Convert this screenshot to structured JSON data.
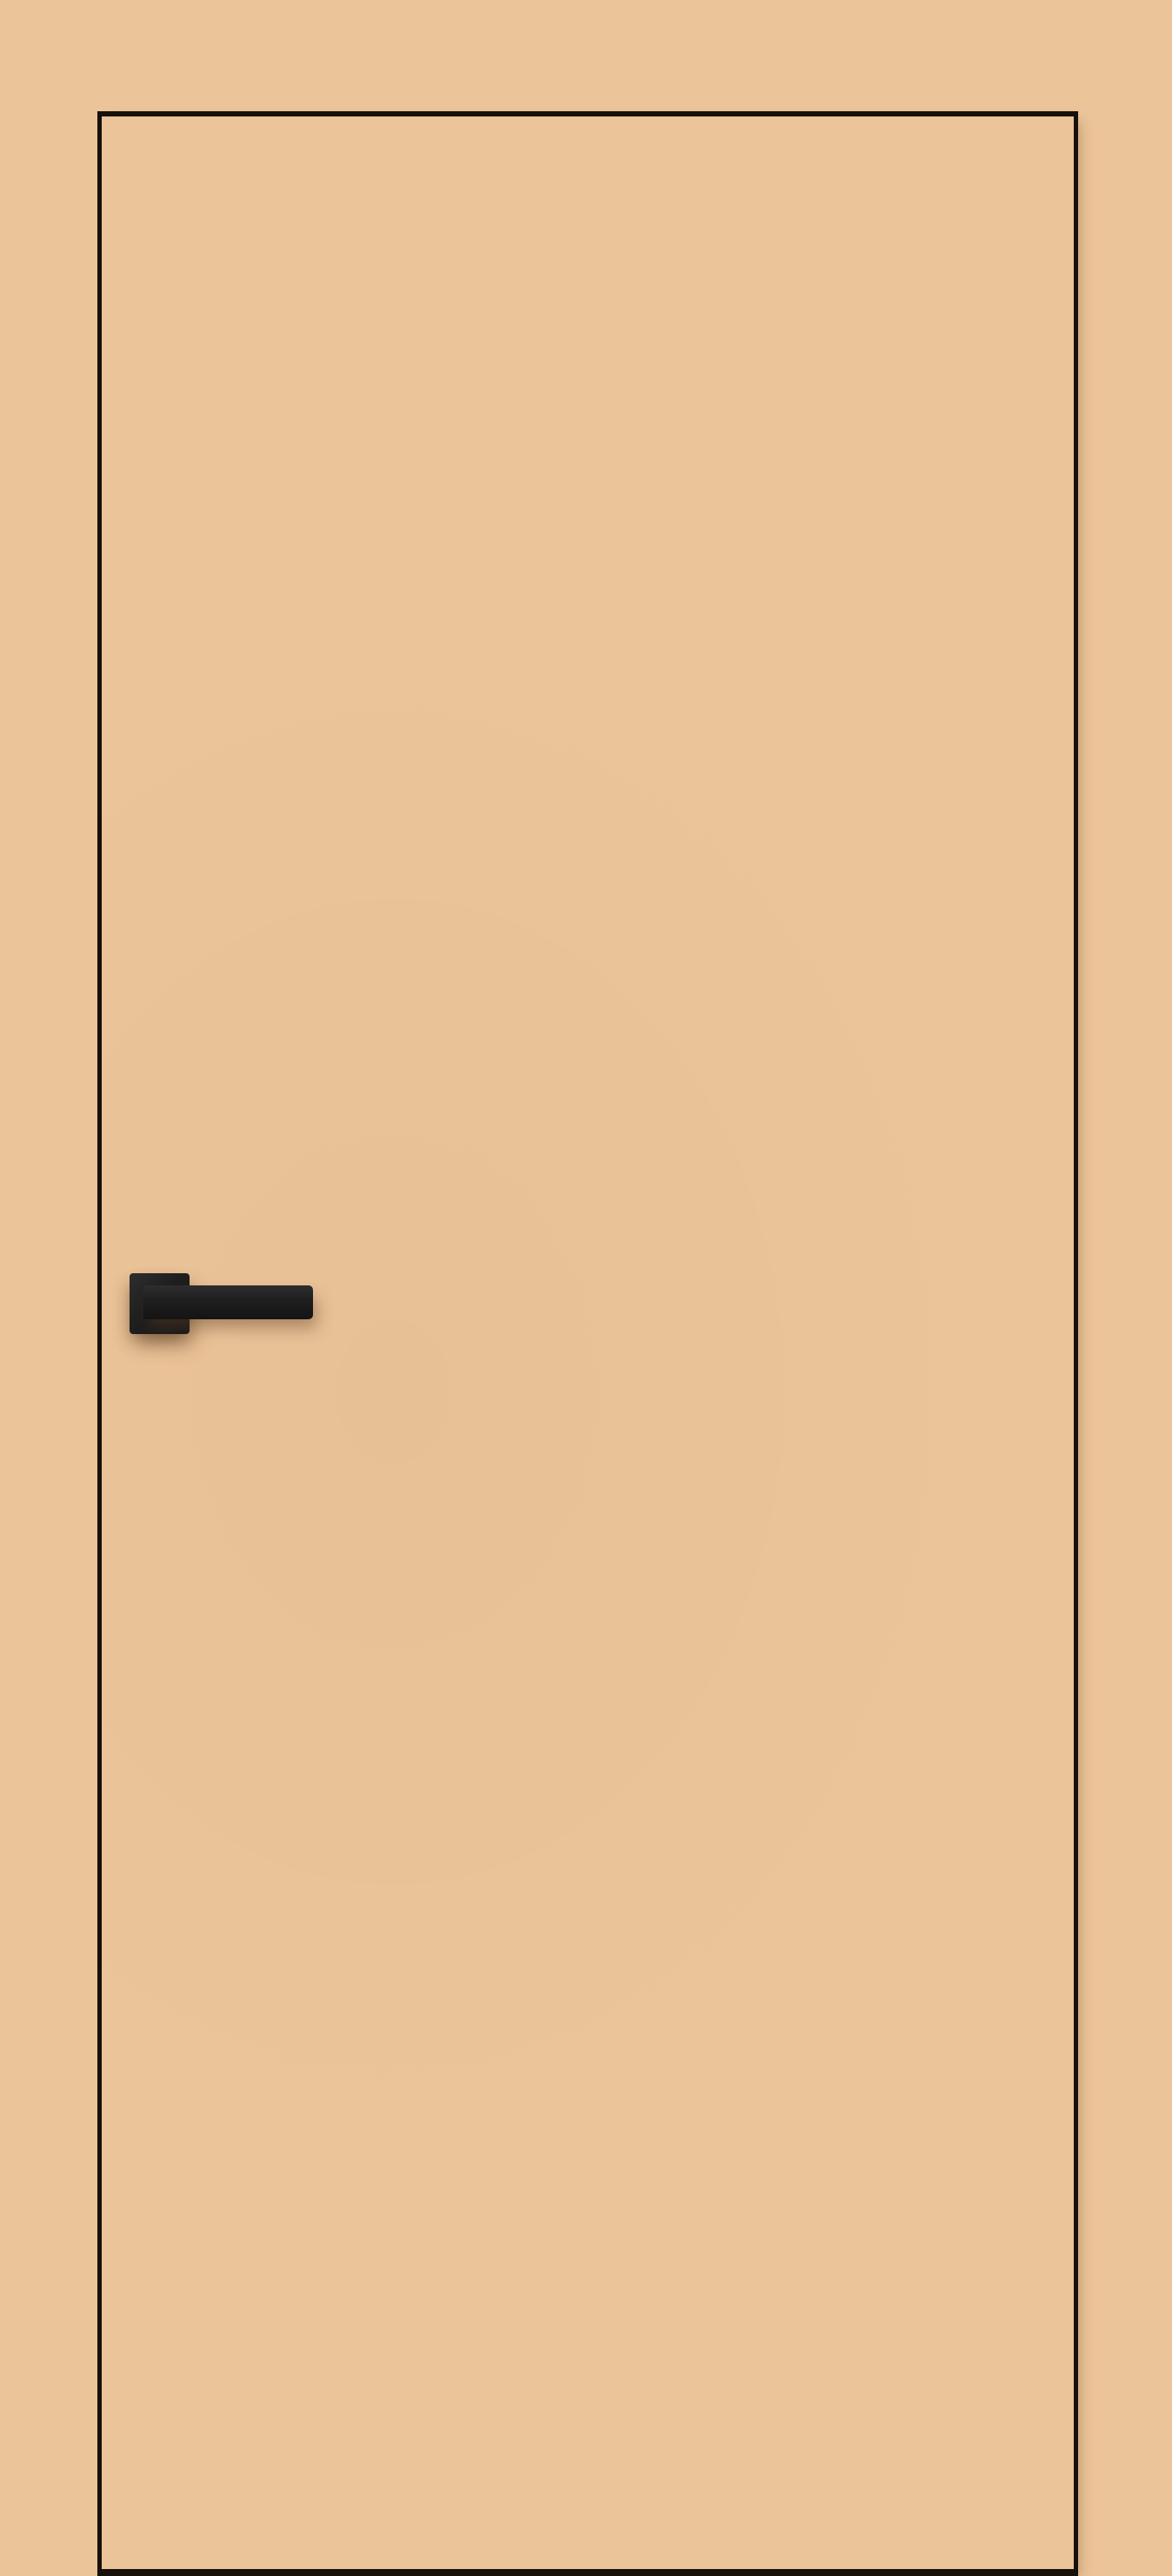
{
  "meta": {
    "description": "Product render of a flush interior door in a tan/beige finish with thin black edge trim and a black square-rosette lever handle on the left side; wall background matches the door color."
  },
  "colors": {
    "wall": "#ecc499",
    "door": "#ecc499",
    "trim": "#17100b",
    "handle": "#1f1f1f",
    "handle-highlight": "#2e2e2e",
    "shadow": "rgba(96,64,36,0.45)",
    "shadow-soft": "rgba(91,58,31,0.35)"
  },
  "door": {
    "style": "flush",
    "trim_outline": "black",
    "handle_side": "left",
    "handle_type": "lever",
    "rosette_shape": "square",
    "handle_finish": "matte-black"
  }
}
